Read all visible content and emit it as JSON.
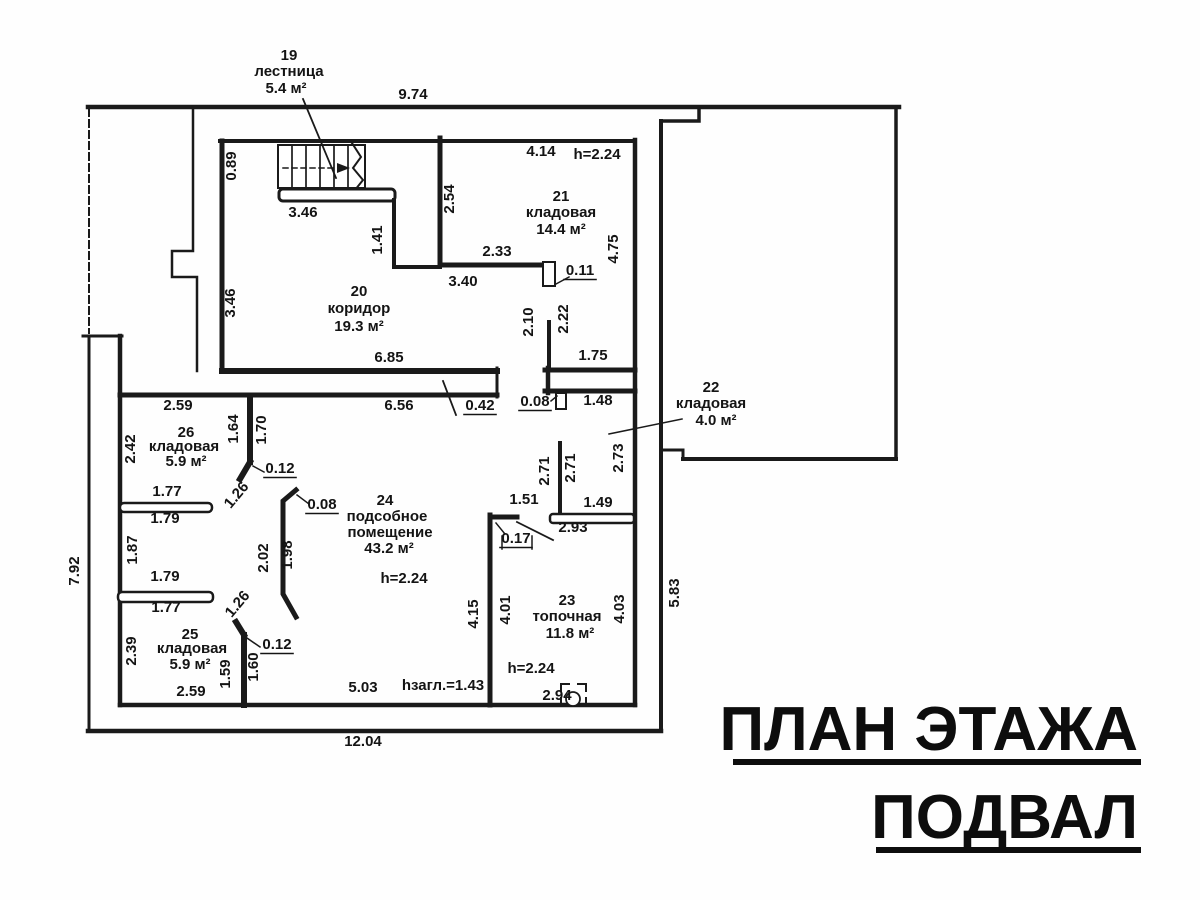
{
  "title": {
    "line1": "ПЛАН ЭТАЖА",
    "line2": "ПОДВАЛ"
  },
  "plan": {
    "rooms": [
      {
        "number": "19",
        "name": "лестница",
        "area": "5.4 м²"
      },
      {
        "number": "20",
        "name": "коридор",
        "area": "19.3 м²"
      },
      {
        "number": "21",
        "name": "кладовая",
        "area": "14.4 м²",
        "ceiling": "h=2.24"
      },
      {
        "number": "22",
        "name": "кладовая",
        "area": "4.0 м²"
      },
      {
        "number": "23",
        "name": "топочная",
        "area": "11.8 м²",
        "ceiling": "h=2.24"
      },
      {
        "number": "24",
        "name": "подсобное помещение",
        "area": "43.2 м²",
        "ceiling": "h=2.24"
      },
      {
        "number": "25",
        "name": "кладовая",
        "area": "5.9 м²"
      },
      {
        "number": "26",
        "name": "кладовая",
        "area": "5.9 м²"
      }
    ],
    "annotations": {
      "basement_depth": "hзагл.=1.43"
    },
    "labels": [
      {
        "t": "19",
        "x": 289,
        "y": 60,
        "n": "room-19-number"
      },
      {
        "t": "лестница",
        "x": 289,
        "y": 76,
        "n": "room-19-name"
      },
      {
        "t": "5.4 м²",
        "x": 286,
        "y": 93,
        "n": "room-19-area"
      },
      {
        "t": "20",
        "x": 359,
        "y": 296,
        "n": "room-20-number"
      },
      {
        "t": "коридор",
        "x": 359,
        "y": 313,
        "n": "room-20-name"
      },
      {
        "t": "19.3 м²",
        "x": 359,
        "y": 331,
        "n": "room-20-area"
      },
      {
        "t": "21",
        "x": 561,
        "y": 201,
        "n": "room-21-number"
      },
      {
        "t": "кладовая",
        "x": 561,
        "y": 217,
        "n": "room-21-name"
      },
      {
        "t": "14.4 м²",
        "x": 561,
        "y": 234,
        "n": "room-21-area"
      },
      {
        "t": "h=2.24",
        "x": 597,
        "y": 159,
        "n": "room-21-height"
      },
      {
        "t": "22",
        "x": 711,
        "y": 392,
        "n": "room-22-number"
      },
      {
        "t": "кладовая",
        "x": 711,
        "y": 408,
        "n": "room-22-name"
      },
      {
        "t": "4.0 м²",
        "x": 716,
        "y": 425,
        "n": "room-22-area"
      },
      {
        "t": "23",
        "x": 567,
        "y": 605,
        "n": "room-23-number"
      },
      {
        "t": "топочная",
        "x": 567,
        "y": 621,
        "n": "room-23-name"
      },
      {
        "t": "11.8 м²",
        "x": 570,
        "y": 638,
        "n": "room-23-area"
      },
      {
        "t": "h=2.24",
        "x": 531,
        "y": 673,
        "n": "room-23-height"
      },
      {
        "t": "24",
        "x": 385,
        "y": 505,
        "n": "room-24-number"
      },
      {
        "t": "подсобное",
        "x": 387,
        "y": 521,
        "n": "room-24-name-line1"
      },
      {
        "t": "помещение",
        "x": 390,
        "y": 537,
        "n": "room-24-name-line2"
      },
      {
        "t": "43.2 м²",
        "x": 389,
        "y": 553,
        "n": "room-24-area"
      },
      {
        "t": "h=2.24",
        "x": 404,
        "y": 583,
        "n": "room-24-height"
      },
      {
        "t": "25",
        "x": 190,
        "y": 639,
        "n": "room-25-number"
      },
      {
        "t": "кладовая",
        "x": 192,
        "y": 653,
        "n": "room-25-name"
      },
      {
        "t": "5.9 м²",
        "x": 190,
        "y": 669,
        "n": "room-25-area"
      },
      {
        "t": "26",
        "x": 186,
        "y": 437,
        "n": "room-26-number"
      },
      {
        "t": "кладовая",
        "x": 184,
        "y": 451,
        "n": "room-26-name"
      },
      {
        "t": "5.9 м²",
        "x": 186,
        "y": 466,
        "n": "room-26-area"
      },
      {
        "t": "9.74",
        "x": 413,
        "y": 99
      },
      {
        "t": "0.89",
        "x": 236,
        "y": 166,
        "r": -90
      },
      {
        "t": "3.46",
        "x": 303,
        "y": 217
      },
      {
        "t": "1.41",
        "x": 382,
        "y": 240,
        "r": -90
      },
      {
        "t": "2.54",
        "x": 454,
        "y": 199,
        "r": -90
      },
      {
        "t": "4.14",
        "x": 541,
        "y": 156
      },
      {
        "t": "2.33",
        "x": 497,
        "y": 256
      },
      {
        "t": "3.40",
        "x": 463,
        "y": 286
      },
      {
        "t": "0.11",
        "x": 580,
        "y": 275,
        "u": 1
      },
      {
        "t": "4.75",
        "x": 618,
        "y": 249,
        "r": -90
      },
      {
        "t": "3.46",
        "x": 235,
        "y": 303,
        "r": -90
      },
      {
        "t": "6.85",
        "x": 389,
        "y": 362
      },
      {
        "t": "6.56",
        "x": 399,
        "y": 410
      },
      {
        "t": "0.42",
        "x": 480,
        "y": 410,
        "u": 1
      },
      {
        "t": "2.10",
        "x": 533,
        "y": 322,
        "r": -90
      },
      {
        "t": "2.22",
        "x": 568,
        "y": 319,
        "r": -90
      },
      {
        "t": "1.75",
        "x": 593,
        "y": 360
      },
      {
        "t": "0.08",
        "x": 535,
        "y": 406,
        "u": 1
      },
      {
        "t": "1.48",
        "x": 598,
        "y": 405
      },
      {
        "t": "2.73",
        "x": 623,
        "y": 458,
        "r": -90
      },
      {
        "t": "2.59",
        "x": 178,
        "y": 410
      },
      {
        "t": "2.42",
        "x": 135,
        "y": 449,
        "r": -90
      },
      {
        "t": "1.64",
        "x": 238,
        "y": 429,
        "r": -90
      },
      {
        "t": "1.70",
        "x": 266,
        "y": 430,
        "r": -90
      },
      {
        "t": "0.12",
        "x": 280,
        "y": 473,
        "u": 1
      },
      {
        "t": "1.26",
        "x": 240,
        "y": 498,
        "r": -50
      },
      {
        "t": "1.77",
        "x": 167,
        "y": 496
      },
      {
        "t": "1.79",
        "x": 165,
        "y": 523
      },
      {
        "t": "1.87",
        "x": 137,
        "y": 550,
        "r": -90
      },
      {
        "t": "1.79",
        "x": 165,
        "y": 581
      },
      {
        "t": "1.77",
        "x": 166,
        "y": 612
      },
      {
        "t": "1.26",
        "x": 241,
        "y": 607,
        "r": -50
      },
      {
        "t": "0.12",
        "x": 277,
        "y": 649,
        "u": 1
      },
      {
        "t": "2.39",
        "x": 136,
        "y": 651,
        "r": -90
      },
      {
        "t": "1.59",
        "x": 230,
        "y": 674,
        "r": -90
      },
      {
        "t": "1.60",
        "x": 258,
        "y": 667,
        "r": -90
      },
      {
        "t": "2.59",
        "x": 191,
        "y": 696
      },
      {
        "t": "0.08",
        "x": 322,
        "y": 509,
        "u": 1
      },
      {
        "t": "2.02",
        "x": 268,
        "y": 558,
        "r": -90
      },
      {
        "t": "1.98",
        "x": 292,
        "y": 555,
        "r": -90
      },
      {
        "t": "1.51",
        "x": 524,
        "y": 504
      },
      {
        "t": "0.17",
        "x": 516,
        "y": 543,
        "u": 1
      },
      {
        "t": "2.71",
        "x": 549,
        "y": 471,
        "r": -90
      },
      {
        "t": "2.71",
        "x": 575,
        "y": 468,
        "r": -90
      },
      {
        "t": "1.49",
        "x": 598,
        "y": 507
      },
      {
        "t": "2.93",
        "x": 573,
        "y": 532
      },
      {
        "t": "4.15",
        "x": 478,
        "y": 614,
        "r": -90
      },
      {
        "t": "4.01",
        "x": 510,
        "y": 610,
        "r": -90
      },
      {
        "t": "4.03",
        "x": 624,
        "y": 609,
        "r": -90
      },
      {
        "t": "5.83",
        "x": 679,
        "y": 593,
        "r": -90
      },
      {
        "t": "5.03",
        "x": 363,
        "y": 692
      },
      {
        "t": "hзагл.=1.43",
        "x": 443,
        "y": 690,
        "n": "depth-annotation"
      },
      {
        "t": "2.94",
        "x": 557,
        "y": 700
      },
      {
        "t": "7.92",
        "x": 79,
        "y": 571,
        "r": -90
      },
      {
        "t": "12.04",
        "x": 363,
        "y": 746
      }
    ]
  }
}
